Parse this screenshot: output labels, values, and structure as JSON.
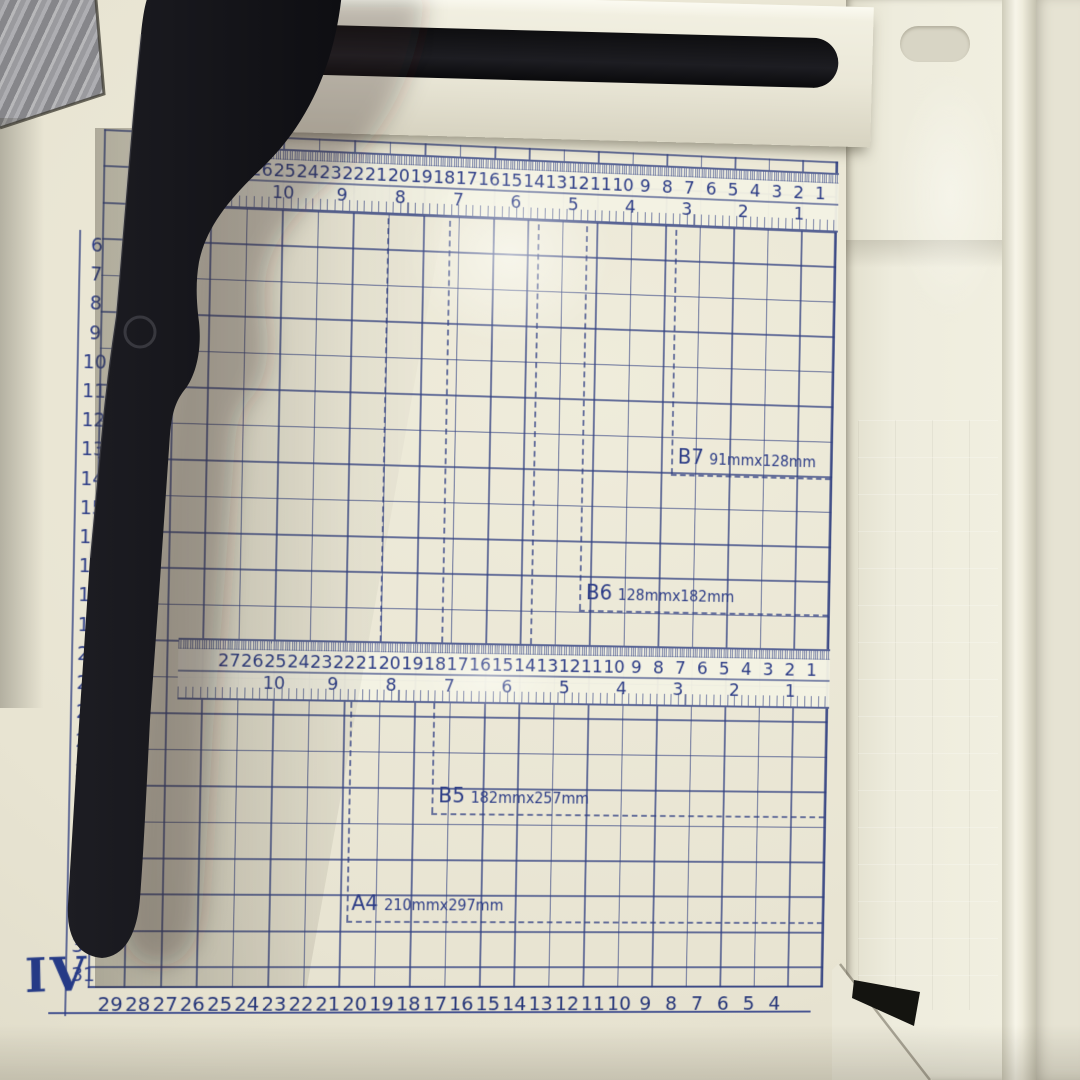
{
  "rulers": {
    "top": {
      "cm_numbers": [
        27,
        26,
        25,
        24,
        23,
        22,
        21,
        20,
        19,
        18,
        17,
        16,
        15,
        14,
        13,
        12,
        11,
        10,
        9,
        8,
        7,
        6,
        5,
        4,
        3,
        2,
        1
      ],
      "inch_numbers": [
        10,
        9,
        8,
        7,
        6,
        5,
        4,
        3,
        2,
        1
      ]
    },
    "middle": {
      "cm_numbers": [
        27,
        26,
        25,
        24,
        23,
        22,
        21,
        20,
        19,
        18,
        17,
        16,
        15,
        14,
        13,
        12,
        11,
        10,
        9,
        8,
        7,
        6,
        5,
        4,
        3,
        2,
        1
      ],
      "inch_numbers": [
        10,
        9,
        8,
        7,
        6,
        5,
        4,
        3,
        2,
        1
      ]
    }
  },
  "left_scale": {
    "values": [
      6,
      7,
      8,
      9,
      10,
      11,
      12,
      13,
      14,
      15,
      16,
      17,
      18,
      19,
      20,
      21,
      22,
      23,
      24,
      25,
      26,
      27,
      28,
      29,
      30,
      31
    ]
  },
  "bottom_scale": {
    "values": [
      29,
      28,
      27,
      26,
      25,
      24,
      23,
      22,
      21,
      20,
      19,
      18,
      17,
      16,
      15,
      14,
      13,
      12,
      11,
      10,
      9,
      8,
      7,
      6,
      5,
      4
    ]
  },
  "size_labels": [
    {
      "code": "B7",
      "dims": "91mmx128mm"
    },
    {
      "code": "B6",
      "dims": "128mmx182mm"
    },
    {
      "code": "B5",
      "dims": "182mmx257mm"
    },
    {
      "code": "A4",
      "dims": "210mmx297mm"
    }
  ],
  "roman_numeral": "IV",
  "colors": {
    "base_cream": "#e8e4d2",
    "grid_blue": "#2f3e80",
    "ink_navy": "#2c3c86",
    "arm_black": "#17171b",
    "floor_grey": "#8f8f92"
  }
}
